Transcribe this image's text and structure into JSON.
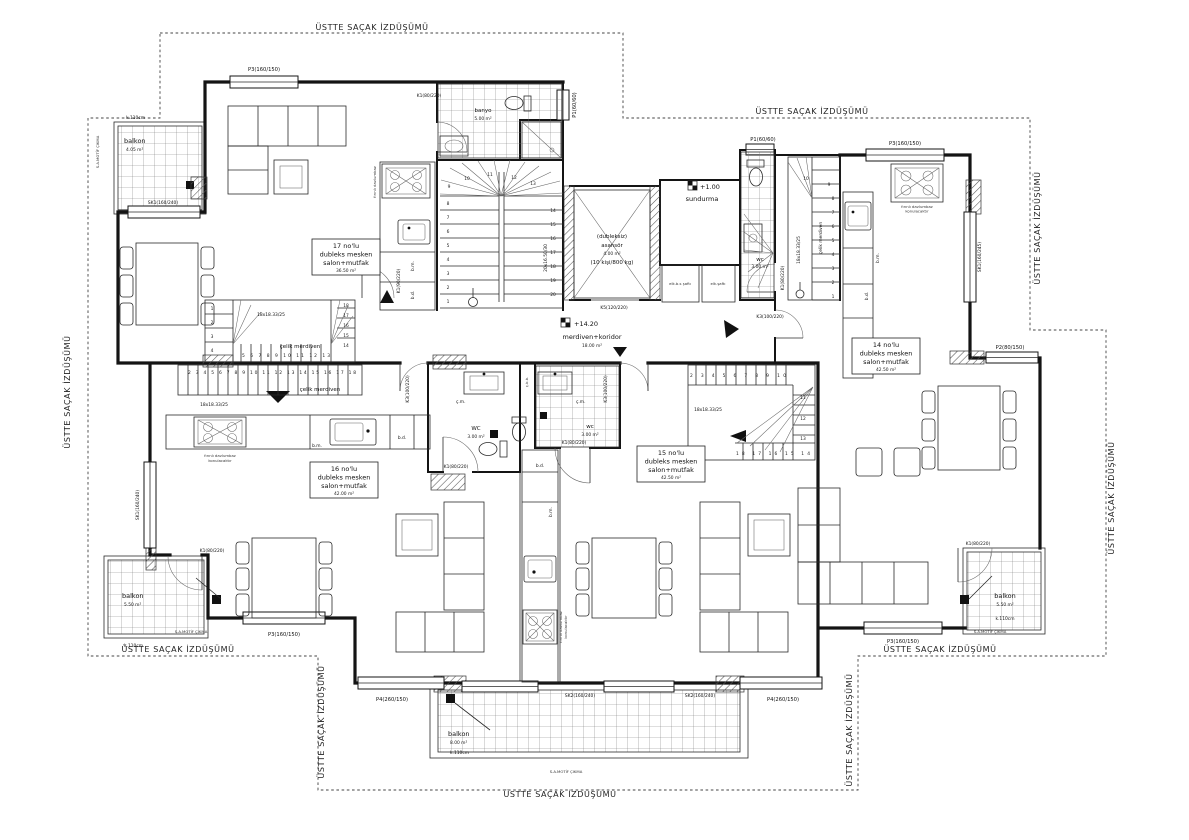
{
  "labels": {
    "eaves": "ÜSTTE SAÇAK İZDÜŞÜMÜ",
    "motif": "S.A.MOTİF ÇIKMA",
    "celik_merdiven": "çelik merdiven",
    "balkon": "balkon",
    "k110": "k.110cm"
  },
  "units": {
    "u17": {
      "no": "17 no'lu",
      "type": "dubleks mesken",
      "rooms": "salon+mutfak",
      "area": "36.50 m²"
    },
    "u16": {
      "no": "16 no'lu",
      "type": "dubleks mesken",
      "rooms": "salon+mutfak",
      "area": "42.00 m²"
    },
    "u15": {
      "no": "15 no'lu",
      "type": "dubleks mesken",
      "rooms": "salon+mutfak",
      "area": "42.50 m²"
    },
    "u14": {
      "no": "14 no'lu",
      "type": "dubleks mesken",
      "rooms": "salon+mutfak",
      "area": "42.50 m²"
    }
  },
  "corridor": {
    "level": "+14.20",
    "name": "merdiven+koridor",
    "area": "18.00 m²"
  },
  "elevator": {
    "note": "(dubleksiz)",
    "name": "asansör",
    "area": "4.00 m²",
    "capacity": "(10 kişi/800 kg)"
  },
  "sundurma": {
    "level": "+1.00",
    "name": "sundurma"
  },
  "banyo": {
    "name": "banyo",
    "area": "5.00 m²"
  },
  "wc_top": {
    "name": "wc",
    "area": "3.00 m²"
  },
  "wc_left": {
    "name": "WC",
    "area": "3.00 m²"
  },
  "wc_right": {
    "name": "wc",
    "area": "3.00 m²"
  },
  "shafts": {
    "a": "elk.b.s şaftı",
    "b": "elk.şaftı"
  },
  "balconies": {
    "tl": "4.05 m²",
    "bl": "5.50 m²",
    "br": "5.50 m²",
    "bc": "8.00 m²"
  },
  "openings": {
    "p3": "P3(160/150)",
    "p1": "P1(60/60)",
    "p2": "P2(80/150)",
    "p4": "P4(260/150)",
    "sk1": "SK1(160/240)",
    "sk1b": "SK1(160/245)",
    "sk2": "SK2(160/240)",
    "k1": "K1(80/220)",
    "k1b": "K1(90/220)",
    "k3": "K3(100/220)",
    "k5": "K5(120/220)"
  },
  "stairs": {
    "main_spec": "20x16.50/30",
    "steel_spec": "18x18.33/25",
    "main_numbers": [
      "1",
      "2",
      "3",
      "4",
      "5",
      "6",
      "7",
      "8",
      "9",
      "10",
      "11",
      "12",
      "13",
      "14",
      "15",
      "16",
      "17",
      "18",
      "19",
      "20"
    ],
    "u14_numbers": [
      "1",
      "2",
      "3",
      "4",
      "5",
      "6",
      "7",
      "8",
      "9",
      "10"
    ],
    "u17_row": "5 6 7 8 9 10 11 12 13",
    "u17_col": [
      "1",
      "2",
      "3",
      "4"
    ],
    "u17_col2": [
      "18",
      "17",
      "16",
      "15",
      "14"
    ],
    "u16_row": "2 3 4 5 6 7 8 9 10 11 12 13 14 15 16 17 18",
    "u15_row": "2 3 4 5 6 7 8 9 10",
    "u15_col": [
      "11",
      "12",
      "13"
    ],
    "u15_row2": "18 17 16 15 14"
  },
  "annotations": {
    "bm": "b.m.",
    "bd": "b.d.",
    "cm": "ç.m.",
    "cbb": "ç.b.b.",
    "hood1": "fırınlı davlumbaz",
    "hood2": "konulacaktır"
  }
}
